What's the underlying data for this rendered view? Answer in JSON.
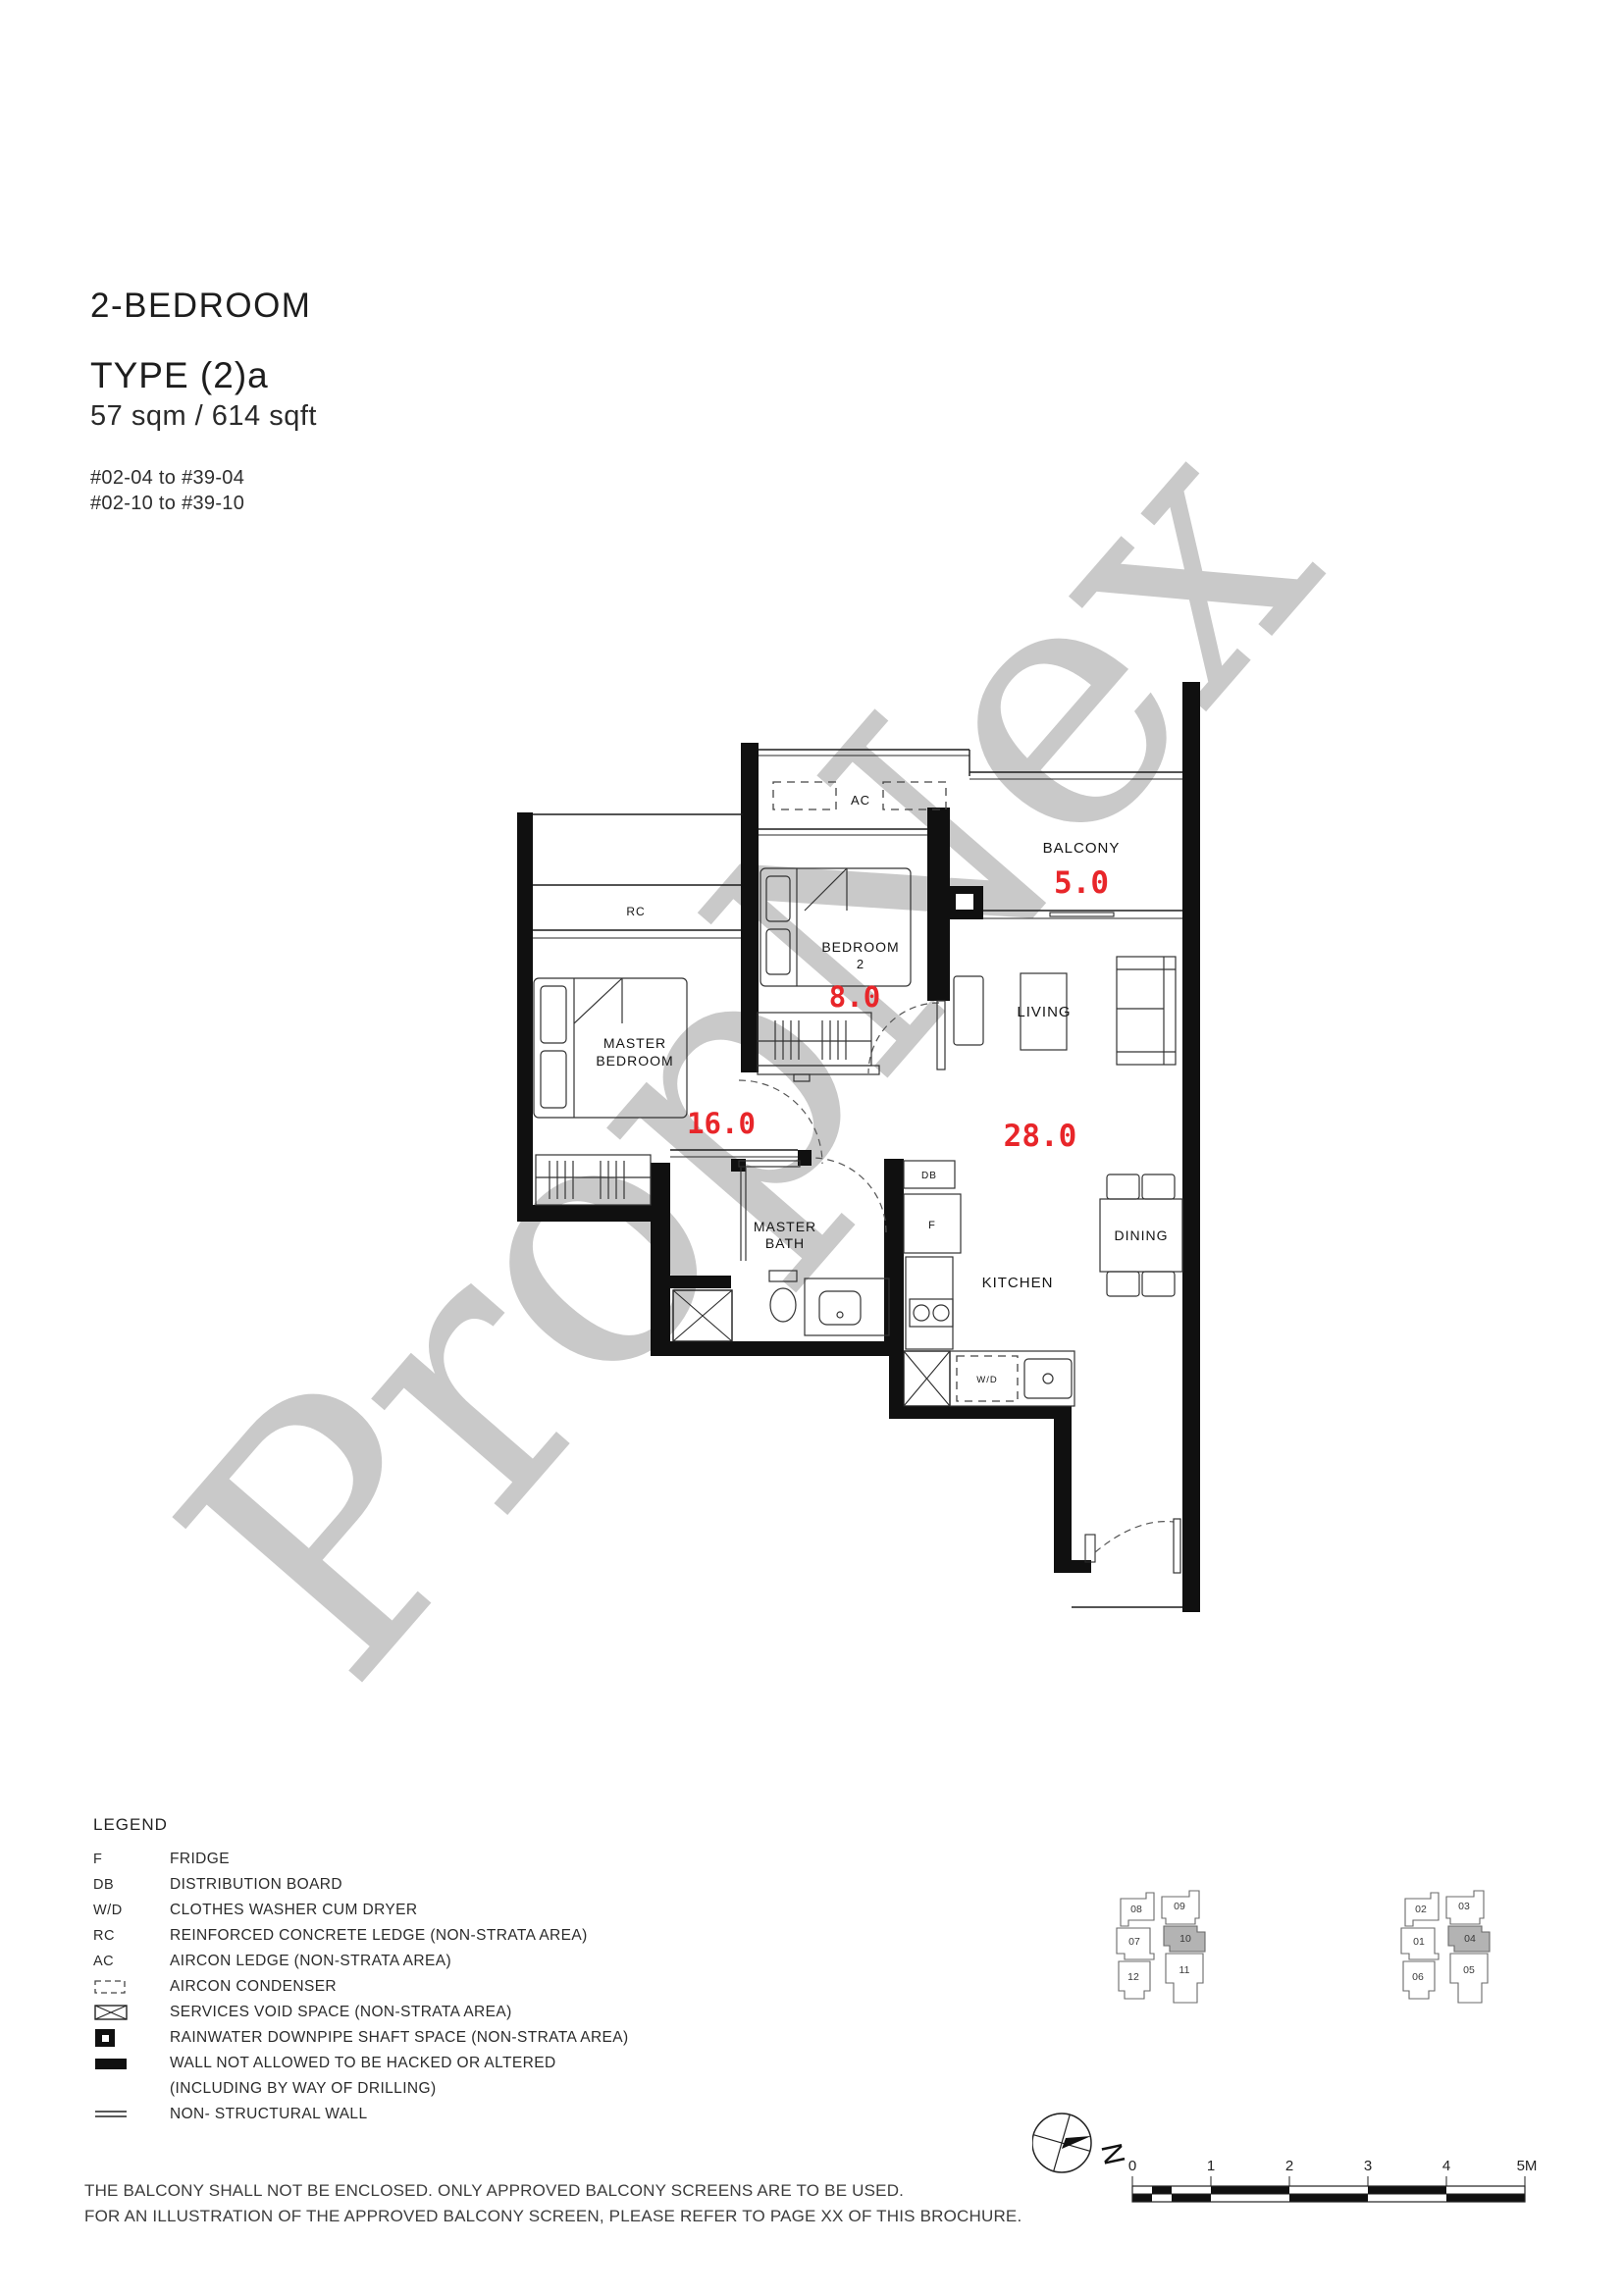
{
  "header": {
    "category": "2-BEDROOM",
    "type_label": "TYPE (2)a",
    "area": "57 sqm / 614 sqft",
    "stack_line1": "#02-04 to #39-04",
    "stack_line2": "#02-10 to #39-10"
  },
  "watermark": {
    "text": "PropNex",
    "color": "#c9c9c9"
  },
  "plan": {
    "labels": {
      "ac": "AC",
      "balcony": "BALCONY",
      "bedroom2_1": "BEDROOM",
      "bedroom2_2": "2",
      "rc": "RC",
      "master_1": "MASTER",
      "master_2": "BEDROOM",
      "living": "LIVING",
      "dining": "DINING",
      "kitchen": "KITCHEN",
      "bath_1": "MASTER",
      "bath_2": "BATH",
      "db": "DB",
      "fridge": "F",
      "wd": "W/D"
    },
    "areas": {
      "balcony": "5.0",
      "bedroom2": "8.0",
      "master": "16.0",
      "living": "28.0"
    },
    "area_color": "#e8262a"
  },
  "legend": {
    "title": "LEGEND",
    "items": [
      {
        "key": "F",
        "icon": "",
        "label": "FRIDGE"
      },
      {
        "key": "DB",
        "icon": "",
        "label": "DISTRIBUTION BOARD"
      },
      {
        "key": "W/D",
        "icon": "",
        "label": "CLOTHES WASHER CUM DRYER"
      },
      {
        "key": "RC",
        "icon": "",
        "label": "REINFORCED CONCRETE LEDGE (NON-STRATA AREA)"
      },
      {
        "key": "AC",
        "icon": "",
        "label": "AIRCON LEDGE (NON-STRATA AREA)"
      },
      {
        "key": "",
        "icon": "aircon-condenser-icon",
        "label": "AIRCON CONDENSER"
      },
      {
        "key": "",
        "icon": "services-void-icon",
        "label": "SERVICES VOID SPACE (NON-STRATA AREA)"
      },
      {
        "key": "",
        "icon": "rainwater-downpipe-icon",
        "label": "RAINWATER DOWNPIPE SHAFT SPACE (NON-STRATA AREA)"
      },
      {
        "key": "",
        "icon": "structural-wall-icon",
        "label": "WALL NOT ALLOWED TO BE HACKED OR ALTERED"
      },
      {
        "key": "",
        "icon": "",
        "label": "(INCLUDING BY WAY OF DRILLING)"
      },
      {
        "key": "",
        "icon": "non-structural-wall-icon",
        "label": "NON- STRUCTURAL WALL"
      }
    ]
  },
  "keyplans": [
    {
      "highlighted": "10",
      "units": [
        {
          "label": "08"
        },
        {
          "label": "09"
        },
        {
          "label": "07"
        },
        {
          "label": "10"
        },
        {
          "label": "12"
        },
        {
          "label": "11"
        }
      ]
    },
    {
      "highlighted": "04",
      "units": [
        {
          "label": "02"
        },
        {
          "label": "03"
        },
        {
          "label": "01"
        },
        {
          "label": "04"
        },
        {
          "label": "06"
        },
        {
          "label": "05"
        }
      ]
    }
  ],
  "compass": {
    "label": "N"
  },
  "scalebar": {
    "ticks": [
      "0",
      "1",
      "2",
      "3",
      "4",
      "5M"
    ]
  },
  "footnotes": {
    "line1": "THE BALCONY SHALL NOT BE ENCLOSED. ONLY APPROVED BALCONY SCREENS ARE TO BE USED.",
    "line2": "FOR AN ILLUSTRATION OF THE APPROVED BALCONY SCREEN, PLEASE REFER TO PAGE XX OF THIS BROCHURE."
  }
}
